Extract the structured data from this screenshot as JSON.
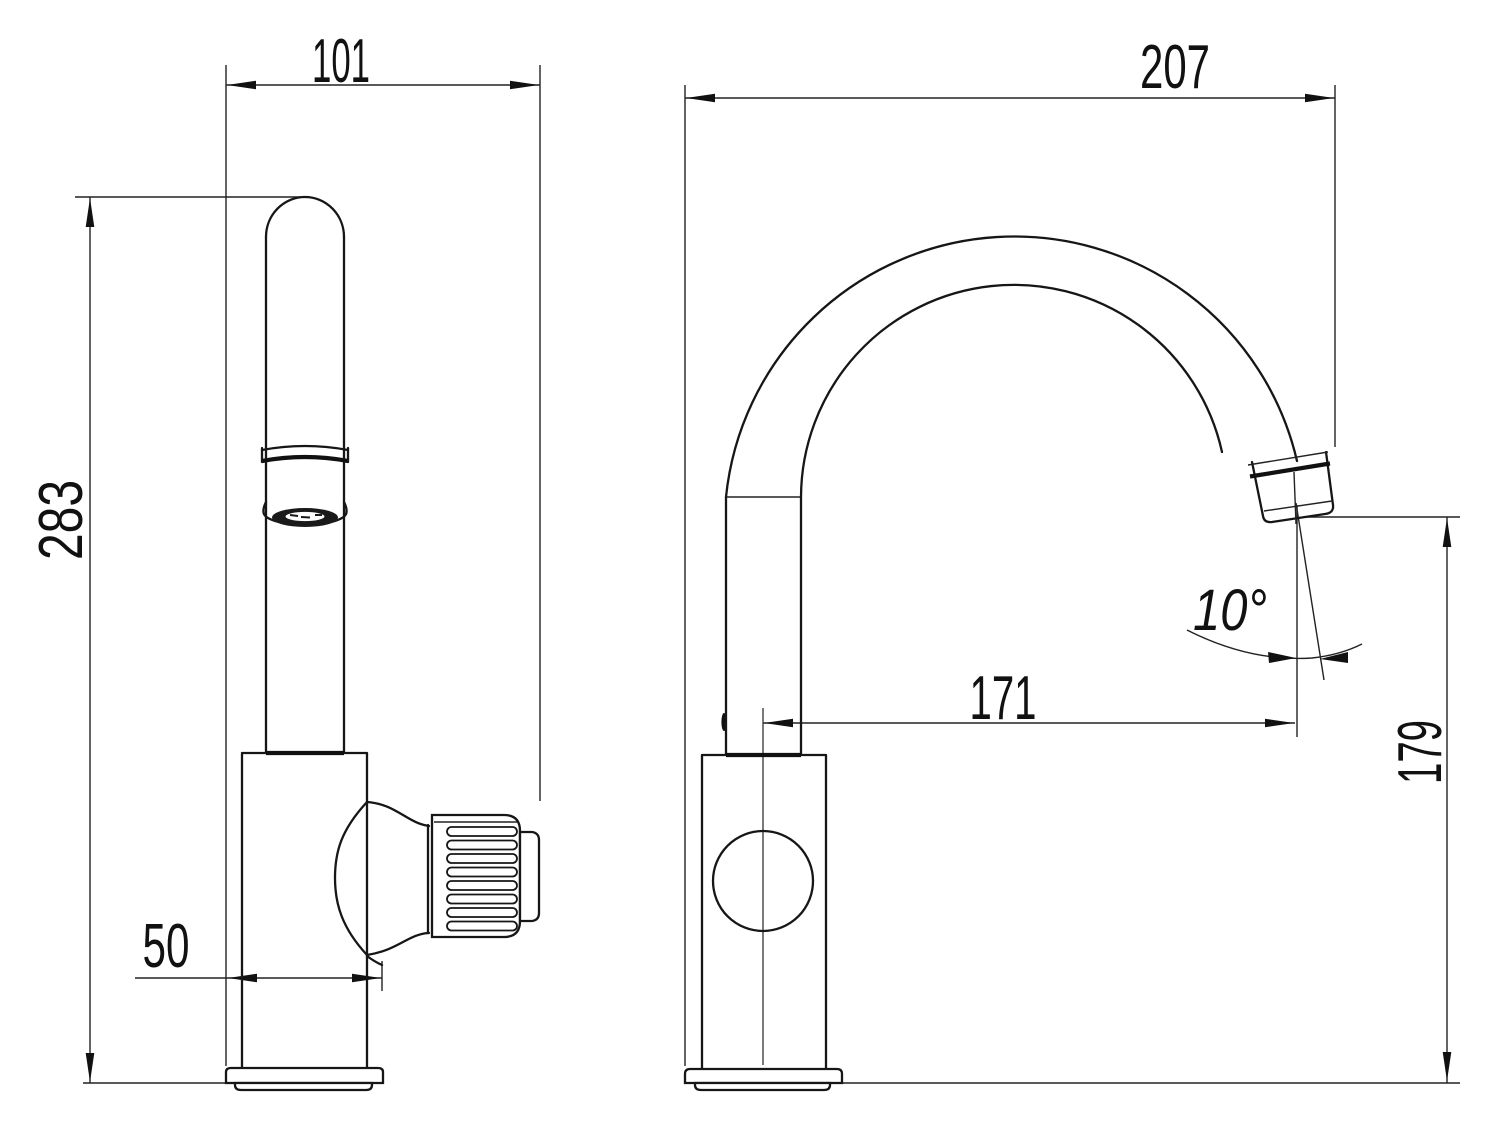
{
  "drawing": {
    "title": "faucet-two-view-dimension-drawing",
    "background": "#ffffff",
    "line_color": "#161616",
    "views": {
      "left_view": "side-profile-with-handle-knob",
      "right_view": "front-profile-with-gooseneck-spout"
    },
    "dimensions": {
      "spout_depth": {
        "value": "101",
        "orientation": "horizontal"
      },
      "overall_reach": {
        "value": "207",
        "orientation": "horizontal"
      },
      "overall_height": {
        "value": "283",
        "orientation": "vertical"
      },
      "base_depth": {
        "value": "50",
        "orientation": "horizontal"
      },
      "spout_reach": {
        "value": "171",
        "orientation": "horizontal"
      },
      "outlet_height": {
        "value": "179",
        "orientation": "vertical"
      },
      "outlet_angle": {
        "value": "10°",
        "orientation": "angular"
      }
    }
  }
}
